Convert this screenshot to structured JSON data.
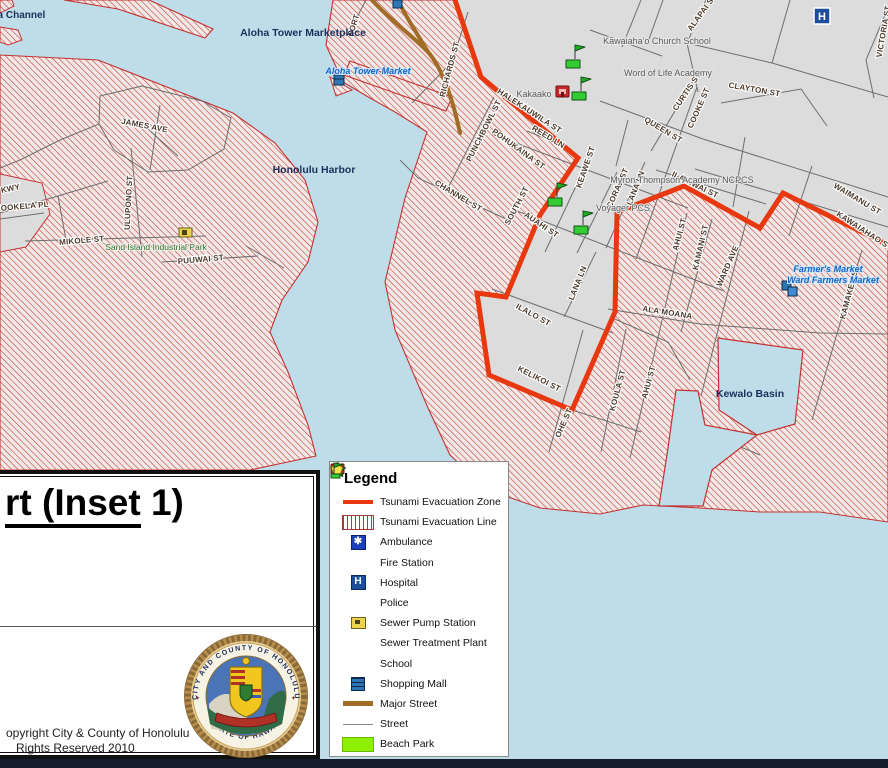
{
  "legend": {
    "title": "Legend",
    "items": [
      {
        "key": "evac-zone",
        "label": "Tsunami Evacuation Zone"
      },
      {
        "key": "evac-line",
        "label": "Tsunami Evacuation Line"
      },
      {
        "key": "ambulance",
        "label": "Ambulance"
      },
      {
        "key": "fire-station",
        "label": "Fire Station"
      },
      {
        "key": "hospital",
        "label": "Hospital"
      },
      {
        "key": "police",
        "label": "Police"
      },
      {
        "key": "sewer-pump",
        "label": "Sewer Pump Station"
      },
      {
        "key": "sewer-treatment",
        "label": "Sewer Treatment Plant"
      },
      {
        "key": "school",
        "label": "School"
      },
      {
        "key": "shopping-mall",
        "label": "Shopping Mall"
      },
      {
        "key": "major-street",
        "label": "Major Street"
      },
      {
        "key": "street",
        "label": "Street"
      },
      {
        "key": "beach-park",
        "label": "Beach Park"
      }
    ]
  },
  "title_block": {
    "title_underlined": "rt (Inset",
    "title_rest": " 1)",
    "copyright_line1": "opyright City & County of Honolulu",
    "copyright_line2": "Rights Reserved 2010",
    "seal_top_text": "CITY AND COUNTY OF HONOLULU",
    "seal_bottom_text": "STATE OF HAWAII"
  },
  "map": {
    "street_labels": [
      {
        "t": "FORT"
      },
      {
        "t": "RICHARDS ST"
      },
      {
        "t": "ALAPAI ST"
      },
      {
        "t": "VICTORIA ST"
      },
      {
        "t": "HALEKAUWILA ST"
      },
      {
        "t": "REED LN"
      },
      {
        "t": "POHUKAINA ST"
      },
      {
        "t": "PUNCHBOWL ST"
      },
      {
        "t": "CHANNEL ST"
      },
      {
        "t": "QUEEN ST"
      },
      {
        "t": "CURTIS ST"
      },
      {
        "t": "COOKE ST"
      },
      {
        "t": "CLAYTON ST"
      },
      {
        "t": "KEAWE ST"
      },
      {
        "t": "CORAL ST"
      },
      {
        "t": "LANA LN"
      },
      {
        "t": "ILANIWAI ST"
      },
      {
        "t": "WAIMANU ST"
      },
      {
        "t": "KAWAIAHAO ST"
      },
      {
        "t": "SOUTH ST"
      },
      {
        "t": "AUAHI ST"
      },
      {
        "t": "LANA LN"
      },
      {
        "t": "ILALO ST"
      },
      {
        "t": "KELIKOI ST"
      },
      {
        "t": "OHE ST"
      },
      {
        "t": "KOULA ST"
      },
      {
        "t": "AHUI ST"
      },
      {
        "t": "AHUI ST"
      },
      {
        "t": "KAMANI ST"
      },
      {
        "t": "WARD AVE"
      },
      {
        "t": "KAMAKEE ST"
      },
      {
        "t": "ALA MOANA"
      },
      {
        "t": "MIKOLE ST"
      },
      {
        "t": "PUUWAI ST"
      },
      {
        "t": "JAMES AVE"
      },
      {
        "t": "ULUPONO ST"
      },
      {
        "t": "HOOKELA PL"
      },
      {
        "t": "KWY"
      }
    ],
    "water_labels": [
      {
        "t": "ma Channel"
      },
      {
        "t": "Aloha Tower Marketplace"
      },
      {
        "t": "Honolulu Harbor"
      },
      {
        "t": "Kewalo Basin"
      }
    ],
    "place_labels": [
      {
        "t": "Kawaiaha'o Church School"
      },
      {
        "t": "Word of Life Academy"
      },
      {
        "t": "Kakaako"
      },
      {
        "t": "Myron Thompson Academy NCPCS"
      },
      {
        "t": "Voyager PCS"
      }
    ],
    "mall_labels": [
      {
        "t": "Aloha Tower Market"
      },
      {
        "t": "Farmer's Market"
      },
      {
        "t": "Ward Farmers Market"
      }
    ],
    "area_labels": [
      {
        "t": "Sand Island Industrial Park"
      }
    ],
    "icons": {
      "hospital_letter": "H",
      "ambulance_glyph": "✱"
    }
  },
  "colors": {
    "water": "#bfdde9",
    "land": "#dcdcdc",
    "hatch_bg": "#f1e7e6",
    "hatch_line": "#c0392b",
    "evac_zone": "#e8380f",
    "coast_line": "#c33333",
    "major_street": "#a06c26",
    "street": "#6e6e6e",
    "beach_park": "#8cf000"
  }
}
